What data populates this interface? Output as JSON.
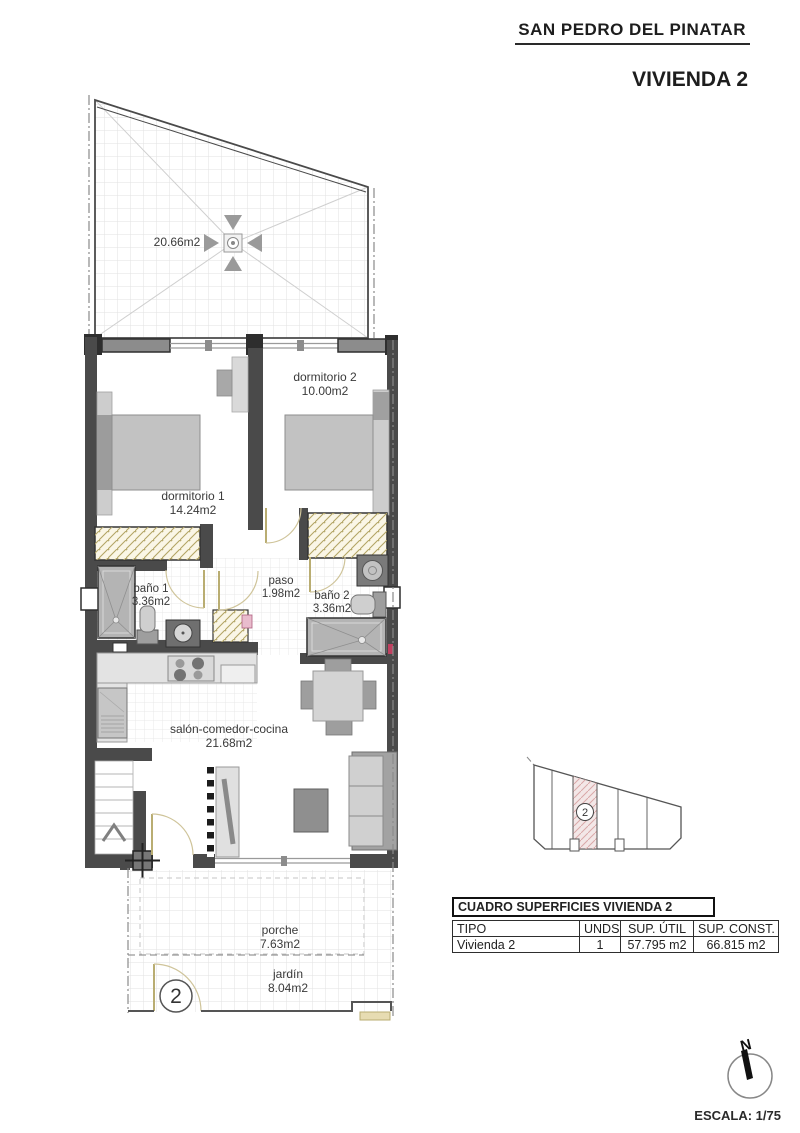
{
  "header": {
    "location": "SAN PEDRO DEL PINATAR",
    "title": "VIVIENDA 2"
  },
  "plan": {
    "solarium_area": "20.66m2",
    "rooms": [
      {
        "name": "dormitorio 2",
        "area": "10.00m2"
      },
      {
        "name": "dormitorio 1",
        "area": "14.24m2"
      },
      {
        "name": "baño 1",
        "area": "3.36m2"
      },
      {
        "name": "paso",
        "area": "1.98m2"
      },
      {
        "name": "baño 2",
        "area": "3.36m2"
      },
      {
        "name": "salón-comedor-cocina",
        "area": "21.68m2"
      },
      {
        "name": "porche",
        "area": "7.63m2"
      },
      {
        "name": "jardín",
        "area": "8.04m2"
      }
    ],
    "unit_number": "2"
  },
  "site_diagram": {
    "highlighted_plot": "2"
  },
  "surface_table": {
    "title": "CUADRO SUPERFICIES VIVIENDA 2",
    "headers": [
      "TIPO",
      "UNDS.",
      "SUP. ÚTIL",
      "SUP. CONST."
    ],
    "rows": [
      [
        "Vivienda 2",
        "1",
        "57.795 m2",
        "66.815 m2"
      ]
    ]
  },
  "compass": {
    "north_label": "N"
  },
  "scale_label": "ESCALA: 1/75",
  "colors": {
    "wall": "#4a4a4a",
    "window_sill": "#8c8c8c",
    "door_arc": "#c9bd8a",
    "wardrobe_hatch": "#b3a565",
    "plot_highlight": "#f3e7e7",
    "furniture": "#c2c2c2"
  }
}
